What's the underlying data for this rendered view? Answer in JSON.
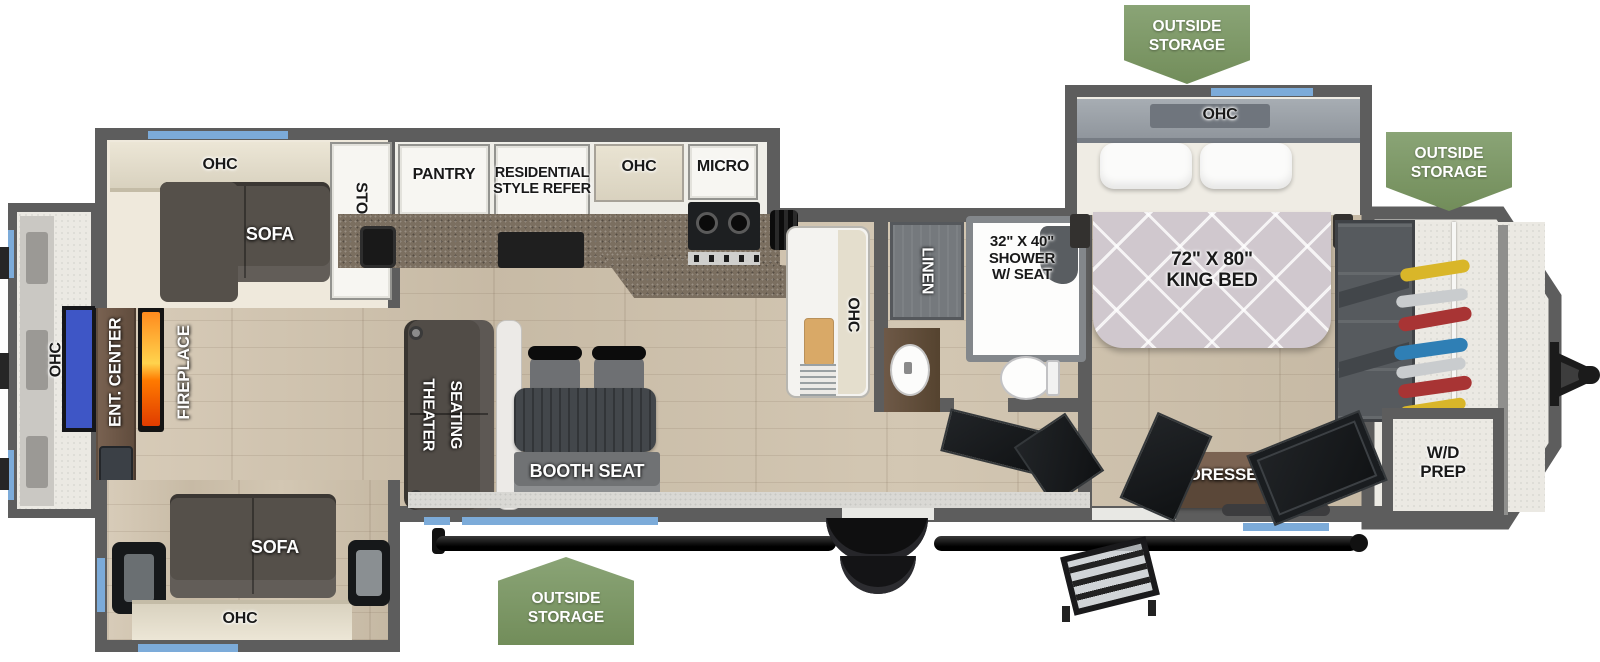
{
  "badge": {
    "text": "OUTSIDE\nSTORAGE"
  },
  "rear": {
    "ohc": "OHC",
    "ent_center": "ENT. CENTER",
    "fireplace": "FIREPLACE"
  },
  "living": {
    "slide_ohc": "OHC",
    "slide_sofa": "SOFA",
    "storage": "STORAGE",
    "theater_line1": "THEATER",
    "theater_line2": "SEATING",
    "booth_seat": "BOOTH SEAT",
    "bottom_sofa": "SOFA",
    "bottom_ohc": "OHC"
  },
  "kitchen": {
    "pantry": "PANTRY",
    "refer": "RESIDENTIAL\nSTYLE REFER",
    "ohc": "OHC",
    "micro": "MICRO",
    "island_ohc": "OHC"
  },
  "bath": {
    "linen": "LINEN",
    "shower": "32\" X 40\"\nSHOWER\nW/ SEAT"
  },
  "bedroom": {
    "ohc": "OHC",
    "king_bed": "72\" X 80\"\nKING BED",
    "dresser": "DRESSER",
    "wd_prep": "W/D\nPREP"
  },
  "colors": {
    "wall": "#5d5d5d",
    "window_accent": "#7cabd9",
    "badge_green": "#7d9766",
    "floor_wood": "#cdc1ae",
    "counter_granite": "#7b6f60",
    "sofa": "#55504a",
    "bed_mattress": "#d0c8ce",
    "tv_screen": "#3e56c6",
    "fireplace_flame": "#ff7a00",
    "wood_cabinet": "#6e5847"
  }
}
